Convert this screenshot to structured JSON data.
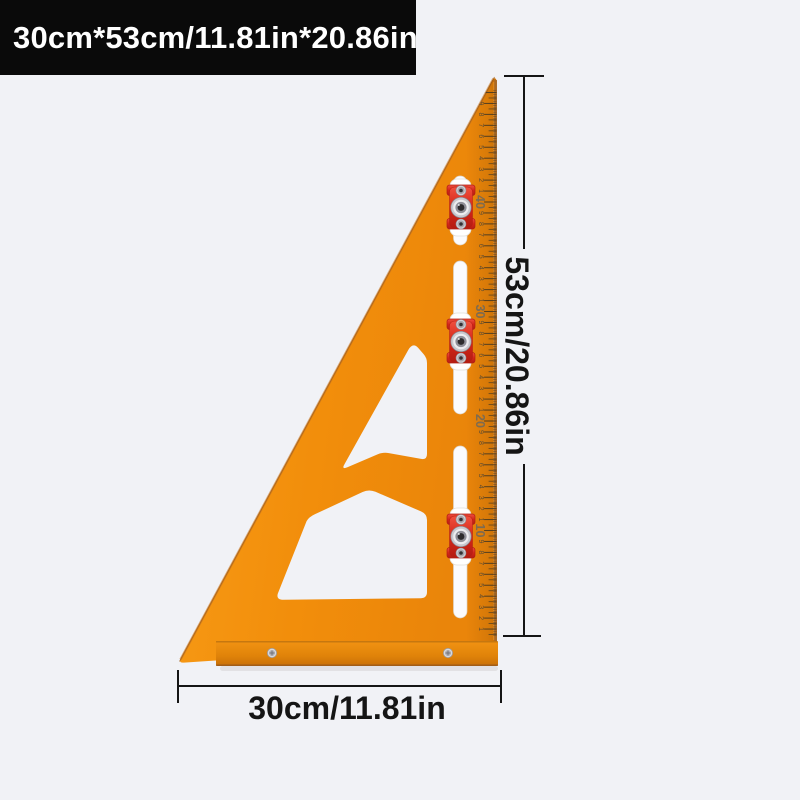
{
  "banner": {
    "text": "30cm*53cm/11.81in*20.86in",
    "bg_color": "#0a0a0a",
    "text_color": "#ffffff"
  },
  "dimensions": {
    "vertical_label": "53cm/20.86in",
    "horizontal_label": "30cm/11.81in",
    "line_color": "#151515"
  },
  "ruler": {
    "plate_color": "#f28e0b",
    "edge_bevel_color": "#a4692c",
    "slot_color": "#fbfbfd",
    "fence_color": "#e08309",
    "scale": {
      "unit": "cm",
      "px_per_cm": 10.95,
      "zero_y": 640,
      "edge_x": 496.6,
      "max_cm": 50,
      "decade_labels": [
        "10",
        "20",
        "30",
        "40"
      ],
      "tick_color": "#4a3a22",
      "digit_color": "#5e4c32",
      "decade_color": "#7d6b51"
    },
    "slots": [
      {
        "y1": 176,
        "y2": 245
      },
      {
        "y1": 261,
        "y2": 414
      },
      {
        "y1": 446,
        "y2": 618
      }
    ],
    "knobs": {
      "color": "#d42719",
      "center_x": 461,
      "centers_y": [
        207,
        341,
        536
      ]
    },
    "fence": {
      "screws_x": [
        272,
        448
      ],
      "screws_y": 653
    }
  },
  "background_color": "#f1f2f6"
}
